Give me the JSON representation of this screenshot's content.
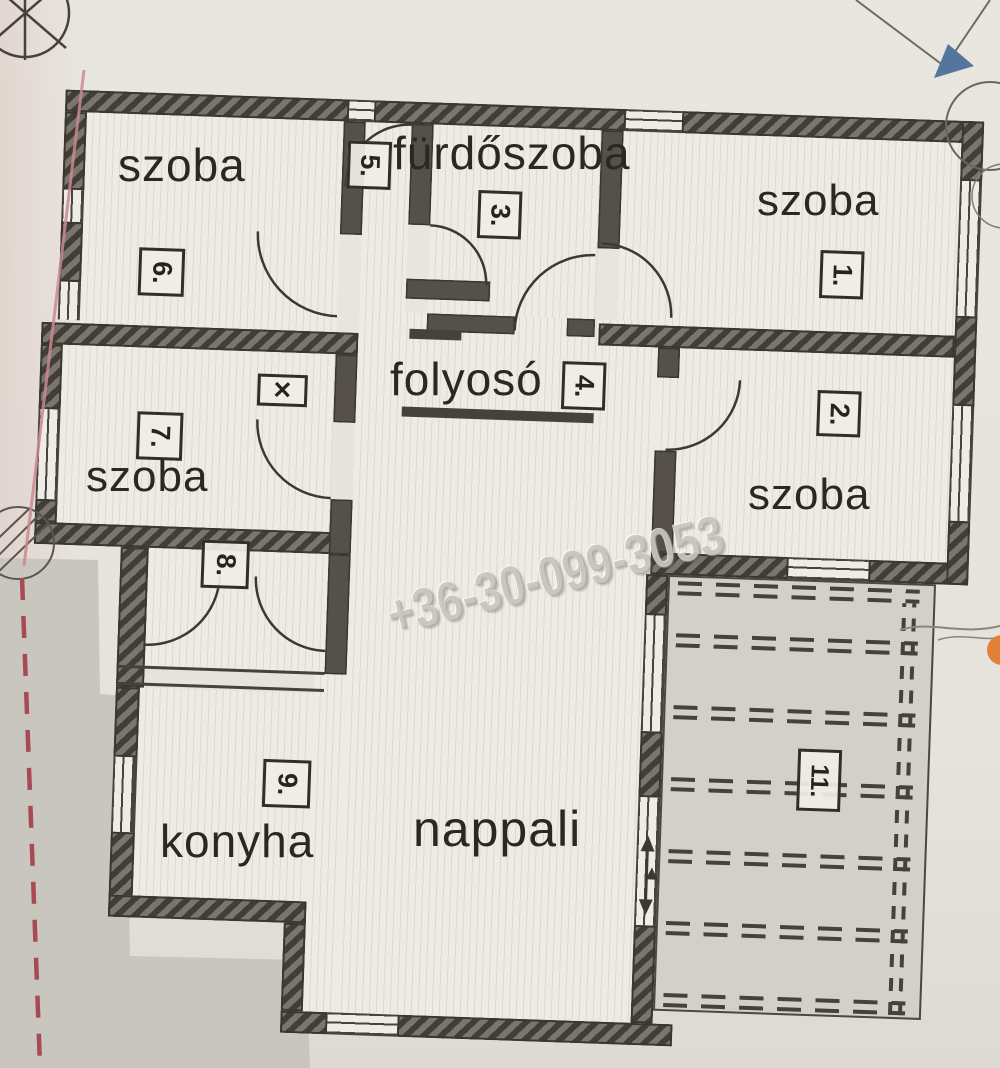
{
  "document": {
    "kind": "apartment floor plan (scanned, Hungarian)",
    "watermark": {
      "phone": "+36-30-099-3053"
    }
  },
  "room_labels": [
    {
      "id": "room-6",
      "text": "szoba"
    },
    {
      "id": "bathroom",
      "text": "fürdőszoba"
    },
    {
      "id": "room-1",
      "text": "szoba"
    },
    {
      "id": "room-2",
      "text": "szoba"
    },
    {
      "id": "hallway",
      "text": "folyosó"
    },
    {
      "id": "room-7",
      "text": "szoba"
    },
    {
      "id": "kitchen",
      "text": "konyha"
    },
    {
      "id": "living-room",
      "text": "nappali"
    }
  ],
  "markers": [
    {
      "text": "5."
    },
    {
      "text": "3."
    },
    {
      "text": "6."
    },
    {
      "text": "1."
    },
    {
      "text": "2."
    },
    {
      "text": "4."
    },
    {
      "text": "7."
    },
    {
      "text": "✕"
    },
    {
      "text": "8."
    },
    {
      "text": "9."
    },
    {
      "text": "11."
    }
  ],
  "colors": {
    "paper": "#e7e3dd",
    "wall_dark": "#413e38",
    "wall_mid": "#7b766d",
    "floor_stripe": "#ddd9d1",
    "terrace_gray": "#d3d0ca",
    "outside_gray": "#c9c6c0",
    "red_dashed_line": "#a84a52",
    "blue_marker": "#54759e",
    "orange_blob": "#e08136"
  }
}
